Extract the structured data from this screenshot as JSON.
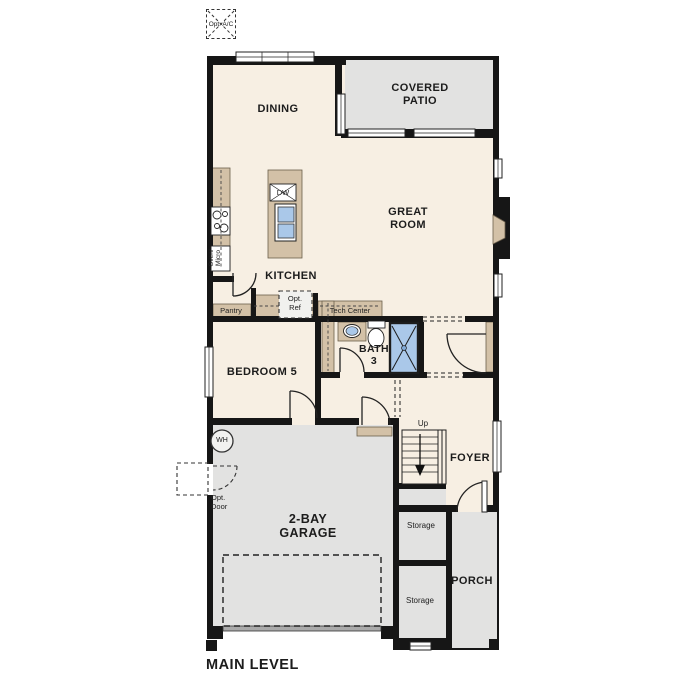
{
  "title": "MAIN LEVEL",
  "colors": {
    "wall": "#161616",
    "interior_floor": "#f7efe3",
    "exterior_floor": "#e2e2e1",
    "cabinet_tan": "#d3c1a7",
    "fixture_blue": "#aac8e9",
    "text": "#1c1c1c"
  },
  "rooms": {
    "dining": "DINING",
    "covered_patio": "COVERED\nPATIO",
    "great_room": "GREAT\nROOM",
    "kitchen": "KITCHEN",
    "bedroom5": "BEDROOM 5",
    "bath3": "BATH\n3",
    "foyer": "FOYER",
    "garage": "2-BAY\nGARAGE",
    "porch": "PORCH",
    "storage1": "Storage",
    "storage2": "Storage",
    "pantry": "Pantry"
  },
  "fixtures": {
    "opt_ac": "Opt.\nA/C",
    "dw": "DW",
    "oven_micro": "Oven/\nMicro",
    "opt_ref": "Opt.\nRef",
    "tech_center": "Tech Center",
    "wh": "WH",
    "opt_door": "Opt.\nDoor",
    "up": "Up"
  },
  "footer": {
    "main_level": "MAIN LEVEL"
  }
}
